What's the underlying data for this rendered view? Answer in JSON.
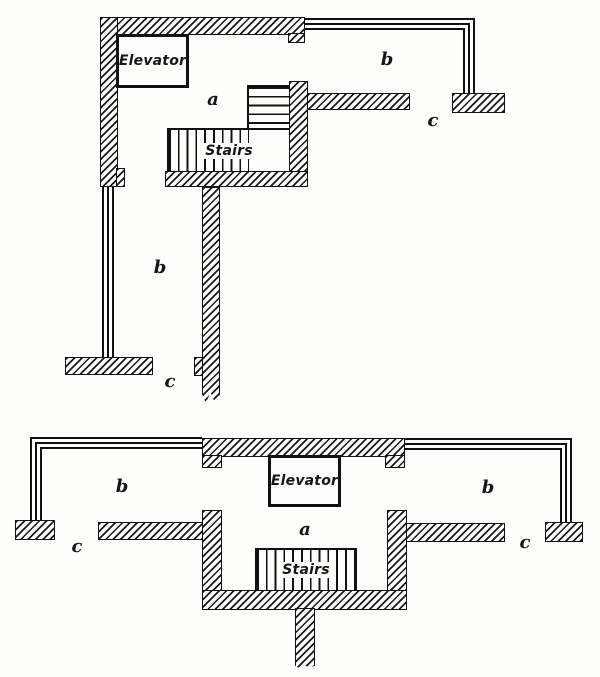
{
  "figure": {
    "description": "Two floor plan diagrams showing elevator and stair arrangement",
    "colors": {
      "ink": "#161616",
      "paper": "#fdfdfc"
    },
    "plans": [
      {
        "id": "upper-plan",
        "elevator_label": "Elevator",
        "stairs_label": "Stairs",
        "label_a": "a",
        "label_b_right": "b",
        "label_c_right": "c",
        "label_b_left": "b",
        "label_c_bottom": "c"
      },
      {
        "id": "lower-plan",
        "elevator_label": "Elevator",
        "stairs_label": "Stairs",
        "label_a": "a",
        "label_b_left": "b",
        "label_b_right": "b",
        "label_c_left": "c",
        "label_c_right": "c"
      }
    ]
  }
}
